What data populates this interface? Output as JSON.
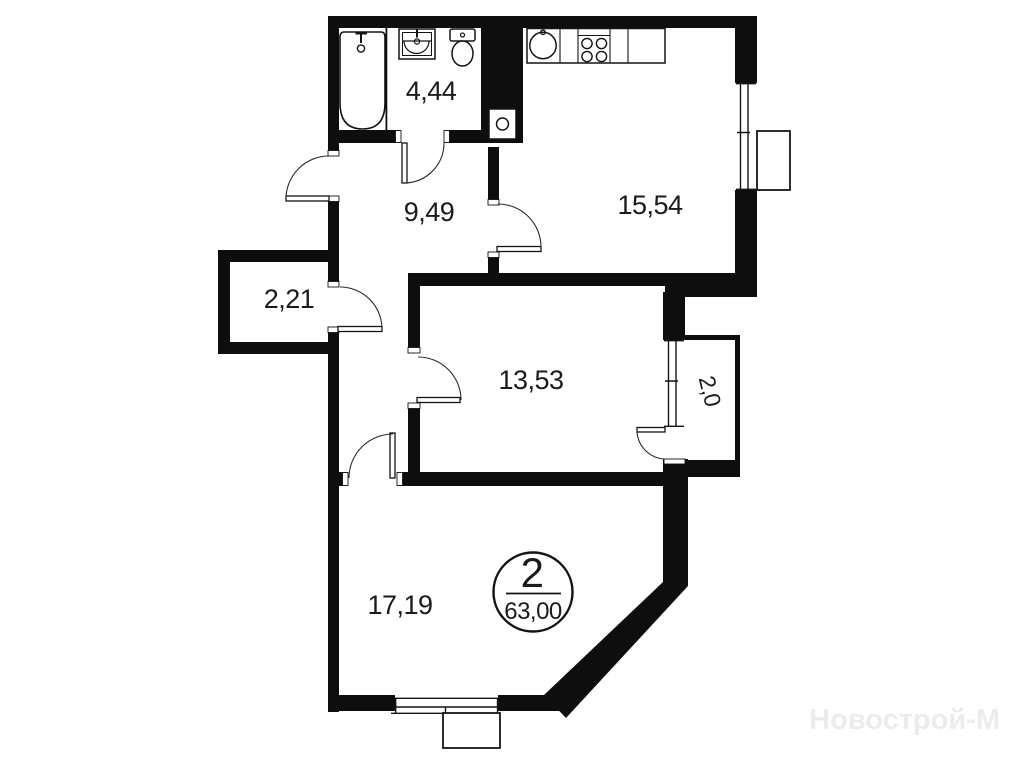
{
  "plan_type": "apartment-floor-plan",
  "rooms": {
    "bathroom": {
      "area": "4,44"
    },
    "hallway": {
      "area": "9,49"
    },
    "kitchen": {
      "area": "15,54"
    },
    "storage": {
      "area": "2,21"
    },
    "room": {
      "area": "13,53"
    },
    "balcony": {
      "area": "2,0"
    },
    "living_room": {
      "area": "17,19"
    }
  },
  "badge": {
    "rooms_count": "2",
    "total_area": "63,00"
  },
  "watermark": "Новострой-М",
  "colors": {
    "walls": "#0e0e0e",
    "background": "#ffffff",
    "labels": "#1b1b1b",
    "watermark": "#ececec"
  }
}
